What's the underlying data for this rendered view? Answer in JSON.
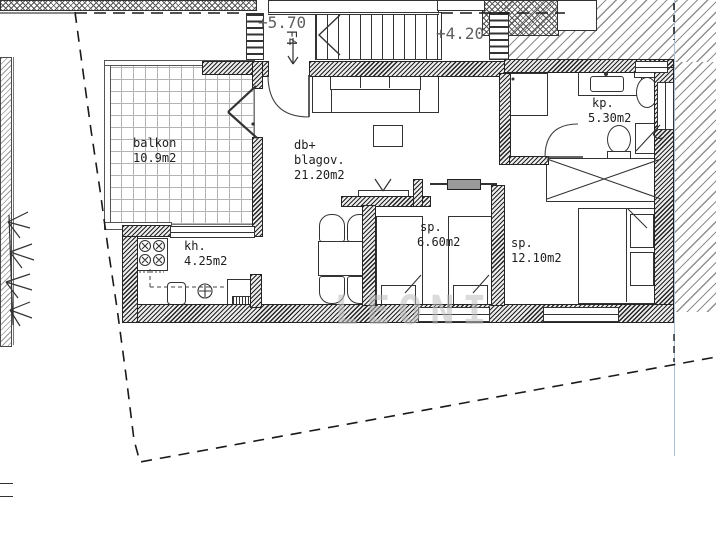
{
  "labels": {
    "upper_level": "+5.70",
    "lower_level": "+4.20",
    "stair_ref": "F4",
    "watermark": "LEONI"
  },
  "rooms": {
    "balcony": {
      "name": "balkon",
      "area": "10.9m2"
    },
    "living": {
      "name_line1": "db+",
      "name_line2": "blagov.",
      "area": "21.20m2"
    },
    "kitchen": {
      "name": "kh.",
      "area": "4.25m2"
    },
    "bedroom_small": {
      "name": "sp.",
      "area": "6.60m2"
    },
    "bedroom_large": {
      "name": "sp.",
      "area": "12.10m2"
    },
    "bathroom": {
      "name": "kp.",
      "area": "5.30m2"
    }
  },
  "colors": {
    "wall": "#242424",
    "roof_hatch": "#8f8f8f",
    "balcony_grid": "#b3b3b3",
    "section_line_blue": "#aac3dd",
    "dim_text": "#5f5f5f",
    "watermark": "rgba(190,190,190,0.55)"
  }
}
